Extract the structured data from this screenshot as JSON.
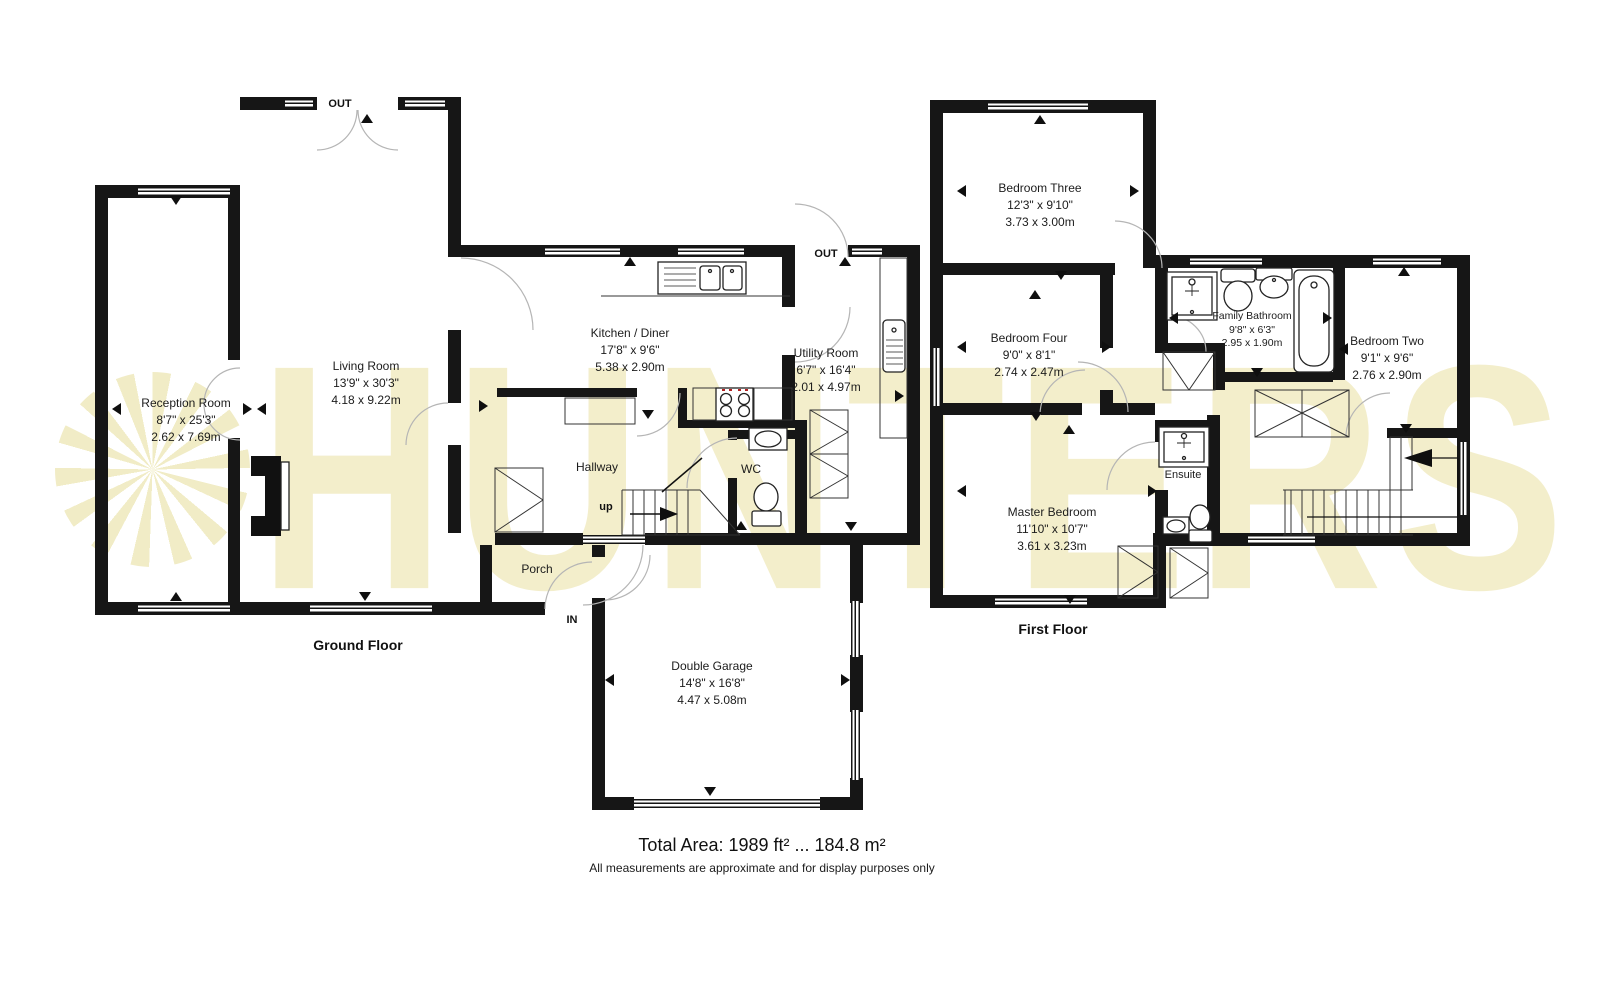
{
  "watermark": {
    "text": "HUNTERS",
    "color": "#f3eecb"
  },
  "ground_floor": {
    "label": "Ground Floor",
    "out_door_label": "OUT",
    "utility_out_label": "OUT",
    "in_door_label": "IN",
    "stairs_label": "up",
    "rooms": [
      {
        "name": "Reception Room",
        "imperial": "8'7\" x 25'3\"",
        "metric": "2.62 x 7.69m"
      },
      {
        "name": "Living Room",
        "imperial": "13'9\" x 30'3\"",
        "metric": "4.18 x 9.22m"
      },
      {
        "name": "Kitchen / Diner",
        "imperial": "17'8\" x 9'6\"",
        "metric": "5.38 x 2.90m"
      },
      {
        "name": "Utility Room",
        "imperial": "6'7\" x 16'4\"",
        "metric": "2.01 x 4.97m"
      },
      {
        "name": "Hallway"
      },
      {
        "name": "WC"
      },
      {
        "name": "Porch"
      },
      {
        "name": "Double Garage",
        "imperial": "14'8\" x 16'8\"",
        "metric": "4.47 x 5.08m"
      }
    ]
  },
  "first_floor": {
    "label": "First Floor",
    "rooms": [
      {
        "name": "Bedroom Three",
        "imperial": "12'3\" x 9'10\"",
        "metric": "3.73 x 3.00m"
      },
      {
        "name": "Bedroom Four",
        "imperial": "9'0\" x 8'1\"",
        "metric": "2.74 x 2.47m"
      },
      {
        "name": "Master Bedroom",
        "imperial": "11'10\" x 10'7\"",
        "metric": "3.61 x 3.23m"
      },
      {
        "name": "Ensuite"
      },
      {
        "name": "Family Bathroom",
        "imperial": "9'8\" x 6'3\"",
        "metric": "2.95 x 1.90m"
      },
      {
        "name": "Bedroom Two",
        "imperial": "9'1\" x 9'6\"",
        "metric": "2.76 x 2.90m"
      }
    ]
  },
  "footer": {
    "total_area": "Total Area: 1989 ft² ... 184.8 m²",
    "disclaimer": "All measurements are approximate and for display purposes only"
  }
}
